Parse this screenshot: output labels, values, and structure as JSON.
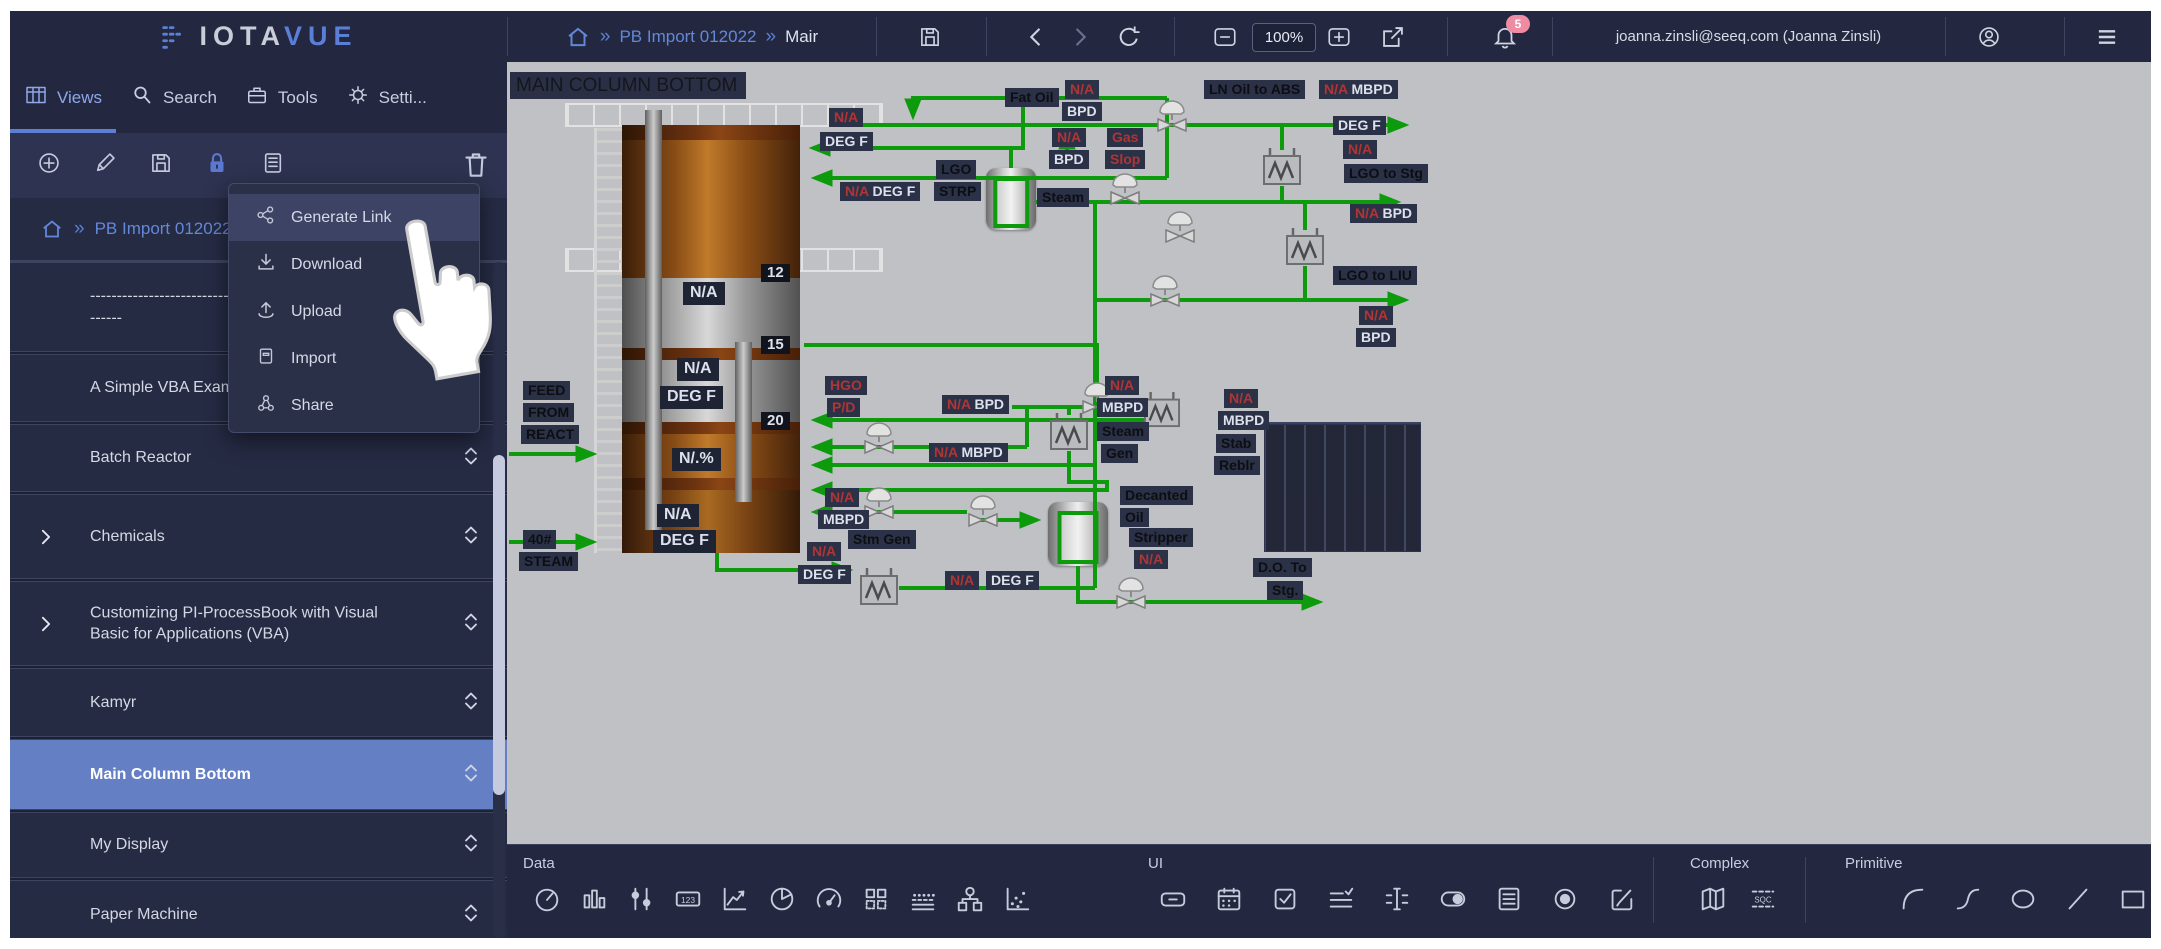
{
  "topbar": {
    "logo_part1": "IOTA",
    "logo_part2": "VUE",
    "breadcrumb": {
      "item1": "PB Import 012022",
      "item2": "Mair"
    },
    "zoom_level": "100%",
    "notifications_badge": "5",
    "user": "joanna.zinsli@seeq.com (Joanna Zinsli)"
  },
  "sidebar": {
    "tabs": [
      {
        "icon": "grid-icon",
        "label": "Views",
        "active": true
      },
      {
        "icon": "search-icon",
        "label": "Search",
        "active": false
      },
      {
        "icon": "tools-icon",
        "label": "Tools",
        "active": false
      },
      {
        "icon": "gear-icon",
        "label": "Setti...",
        "active": false
      }
    ],
    "toolbar_icons": [
      "add-icon",
      "edit-icon",
      "save-icon",
      "lock-icon",
      "list-icon"
    ],
    "breadcrumb": "PB Import 012022",
    "items": [
      {
        "name": "dashed-item",
        "label": "----------------------------------",
        "label2": "------",
        "h": 90,
        "sortable": false,
        "expandable": false,
        "selected": false
      },
      {
        "name": "a-simple-vba-exam",
        "label": "A Simple VBA Exam",
        "h": 68,
        "sortable": true,
        "expandable": false,
        "selected": false
      },
      {
        "name": "batch-reactor",
        "label": "Batch Reactor",
        "h": 68,
        "sortable": true,
        "expandable": false,
        "selected": false
      },
      {
        "name": "chemicals",
        "label": "Chemicals",
        "h": 85,
        "sortable": true,
        "expandable": true,
        "selected": false
      },
      {
        "name": "customizing-pi-processbook",
        "label": "Customizing PI-ProcessBook with Visual Basic for Applications (VBA)",
        "h": 85,
        "sortable": true,
        "expandable": true,
        "selected": false
      },
      {
        "name": "kamyr",
        "label": "Kamyr",
        "h": 69,
        "sortable": true,
        "expandable": false,
        "selected": false
      },
      {
        "name": "main-column-bottom",
        "label": "Main Column Bottom",
        "h": 71,
        "sortable": true,
        "expandable": false,
        "selected": true
      },
      {
        "name": "my-display",
        "label": "My Display",
        "h": 66,
        "sortable": true,
        "expandable": false,
        "selected": false
      },
      {
        "name": "paper-machine",
        "label": "Paper Machine",
        "h": 69,
        "sortable": true,
        "expandable": false,
        "selected": false
      }
    ]
  },
  "menu": {
    "items": [
      {
        "icon": "generate-link-icon",
        "label": "Generate Link",
        "highlighted": true
      },
      {
        "icon": "download-icon",
        "label": "Download",
        "highlighted": false
      },
      {
        "icon": "upload-icon",
        "label": "Upload",
        "highlighted": false
      },
      {
        "icon": "import-icon",
        "label": "Import",
        "highlighted": false
      },
      {
        "icon": "share-icon",
        "label": "Share",
        "highlighted": false
      }
    ]
  },
  "canvas": {
    "title": "MAIN COLUMN BOTTOM",
    "chips": [
      {
        "x": 322,
        "y": 46,
        "p": [
          [
            "N/A",
            "r"
          ]
        ]
      },
      {
        "x": 313,
        "y": 70,
        "p": [
          [
            "DEG F",
            "w"
          ]
        ]
      },
      {
        "x": 498,
        "y": 26,
        "p": [
          [
            "Fat Oil",
            "k"
          ]
        ]
      },
      {
        "x": 333,
        "y": 120,
        "p": [
          [
            "N/A",
            "r"
          ],
          [
            "DEG F",
            "w"
          ]
        ]
      },
      {
        "x": 429,
        "y": 98,
        "p": [
          [
            "LGO",
            "k"
          ]
        ]
      },
      {
        "x": 427,
        "y": 120,
        "p": [
          [
            "STRP",
            "k"
          ]
        ]
      },
      {
        "x": 530,
        "y": 126,
        "p": [
          [
            "Steam",
            "k"
          ]
        ]
      },
      {
        "x": 558,
        "y": 18,
        "p": [
          [
            "N/A",
            "r"
          ]
        ]
      },
      {
        "x": 555,
        "y": 40,
        "p": [
          [
            "BPD",
            "w"
          ]
        ]
      },
      {
        "x": 697,
        "y": 18,
        "p": [
          [
            "LN Oil to ABS",
            "k"
          ]
        ]
      },
      {
        "x": 812,
        "y": 18,
        "p": [
          [
            "N/A",
            "r"
          ],
          [
            "MBPD",
            "w"
          ]
        ]
      },
      {
        "x": 826,
        "y": 54,
        "p": [
          [
            "DEG F",
            "w"
          ]
        ]
      },
      {
        "x": 836,
        "y": 78,
        "p": [
          [
            "N/A",
            "r"
          ]
        ]
      },
      {
        "x": 545,
        "y": 66,
        "p": [
          [
            "N/A",
            "r"
          ]
        ]
      },
      {
        "x": 542,
        "y": 88,
        "p": [
          [
            "BPD",
            "w"
          ]
        ]
      },
      {
        "x": 600,
        "y": 66,
        "p": [
          [
            "Gas",
            "r"
          ]
        ]
      },
      {
        "x": 598,
        "y": 88,
        "p": [
          [
            "Slop",
            "r"
          ]
        ]
      },
      {
        "x": 837,
        "y": 102,
        "p": [
          [
            "LGO to Stg",
            "k"
          ]
        ]
      },
      {
        "x": 843,
        "y": 142,
        "p": [
          [
            "N/A",
            "r"
          ],
          [
            "BPD",
            "w"
          ]
        ]
      },
      {
        "x": 826,
        "y": 204,
        "p": [
          [
            "LGO to LIU",
            "k"
          ]
        ]
      },
      {
        "x": 852,
        "y": 244,
        "p": [
          [
            "N/A",
            "r"
          ]
        ]
      },
      {
        "x": 849,
        "y": 266,
        "p": [
          [
            "BPD",
            "w"
          ]
        ]
      },
      {
        "x": 318,
        "y": 314,
        "p": [
          [
            "HGO",
            "r"
          ]
        ]
      },
      {
        "x": 320,
        "y": 336,
        "p": [
          [
            "P/D",
            "r"
          ]
        ]
      },
      {
        "x": 435,
        "y": 333,
        "p": [
          [
            "N/A",
            "r"
          ],
          [
            "BPD",
            "w"
          ]
        ]
      },
      {
        "x": 598,
        "y": 314,
        "p": [
          [
            "N/A",
            "r"
          ]
        ]
      },
      {
        "x": 590,
        "y": 336,
        "p": [
          [
            "MBPD",
            "w"
          ]
        ]
      },
      {
        "x": 590,
        "y": 360,
        "p": [
          [
            "Steam",
            "k"
          ]
        ]
      },
      {
        "x": 594,
        "y": 382,
        "p": [
          [
            "Gen",
            "k"
          ]
        ]
      },
      {
        "x": 717,
        "y": 327,
        "p": [
          [
            "N/A",
            "r"
          ]
        ]
      },
      {
        "x": 711,
        "y": 349,
        "p": [
          [
            "MBPD",
            "w"
          ]
        ]
      },
      {
        "x": 709,
        "y": 372,
        "p": [
          [
            "Stab",
            "k"
          ]
        ]
      },
      {
        "x": 707,
        "y": 394,
        "p": [
          [
            "Reblr",
            "k"
          ]
        ]
      },
      {
        "x": 422,
        "y": 381,
        "p": [
          [
            "N/A",
            "r"
          ],
          [
            "MBPD",
            "w"
          ]
        ]
      },
      {
        "x": 318,
        "y": 426,
        "p": [
          [
            "N/A",
            "r"
          ]
        ]
      },
      {
        "x": 311,
        "y": 448,
        "p": [
          [
            "MBPD",
            "w"
          ]
        ]
      },
      {
        "x": 341,
        "y": 468,
        "p": [
          [
            "Stm Gen",
            "k"
          ]
        ]
      },
      {
        "x": 300,
        "y": 480,
        "p": [
          [
            "N/A",
            "r"
          ]
        ]
      },
      {
        "x": 291,
        "y": 503,
        "p": [
          [
            "DEG F",
            "w"
          ]
        ]
      },
      {
        "x": 438,
        "y": 509,
        "p": [
          [
            "N/A",
            "r"
          ]
        ]
      },
      {
        "x": 479,
        "y": 509,
        "p": [
          [
            "DEG F",
            "w"
          ]
        ]
      },
      {
        "x": 613,
        "y": 424,
        "p": [
          [
            "Decanted",
            "k"
          ]
        ]
      },
      {
        "x": 613,
        "y": 446,
        "p": [
          [
            "Oil",
            "k"
          ]
        ]
      },
      {
        "x": 622,
        "y": 466,
        "p": [
          [
            "Stripper",
            "k"
          ]
        ]
      },
      {
        "x": 627,
        "y": 488,
        "p": [
          [
            "N/A",
            "r"
          ]
        ]
      },
      {
        "x": 746,
        "y": 496,
        "p": [
          [
            "D.O. To",
            "k"
          ]
        ]
      },
      {
        "x": 760,
        "y": 519,
        "p": [
          [
            "Stg.",
            "k"
          ]
        ]
      },
      {
        "x": 16,
        "y": 319,
        "p": [
          [
            "FEED",
            "k"
          ]
        ]
      },
      {
        "x": 16,
        "y": 341,
        "p": [
          [
            "FROM",
            "k"
          ]
        ]
      },
      {
        "x": 14,
        "y": 363,
        "p": [
          [
            "REACT",
            "k"
          ]
        ]
      },
      {
        "x": 16,
        "y": 468,
        "p": [
          [
            "40#",
            "k"
          ]
        ]
      },
      {
        "x": 12,
        "y": 490,
        "p": [
          [
            "STEAM",
            "k"
          ]
        ]
      },
      {
        "x": 176,
        "y": 220,
        "cls": "box",
        "p": [
          [
            "N/A",
            "w"
          ]
        ]
      },
      {
        "x": 170,
        "y": 296,
        "cls": "box",
        "p": [
          [
            "N/A",
            "w"
          ]
        ]
      },
      {
        "x": 153,
        "y": 324,
        "cls": "box",
        "p": [
          [
            "DEG F",
            "w"
          ]
        ]
      },
      {
        "x": 165,
        "y": 386,
        "cls": "box",
        "p": [
          [
            "N/.%",
            "w"
          ]
        ]
      },
      {
        "x": 150,
        "y": 442,
        "cls": "box",
        "p": [
          [
            "N/A",
            "w"
          ]
        ]
      },
      {
        "x": 146,
        "y": 468,
        "cls": "box",
        "p": [
          [
            "DEG F",
            "w"
          ]
        ]
      },
      {
        "x": 254,
        "y": 202,
        "cls": "tray",
        "p": [
          [
            "12",
            "w"
          ]
        ]
      },
      {
        "x": 254,
        "y": 274,
        "cls": "tray",
        "p": [
          [
            "15",
            "w"
          ]
        ]
      },
      {
        "x": 254,
        "y": 350,
        "cls": "tray",
        "p": [
          [
            "20",
            "w"
          ]
        ]
      }
    ]
  },
  "bottom_toolbar": {
    "sections": [
      {
        "label": "Data",
        "left": 16,
        "icon_start": 22,
        "step": 47,
        "icons": [
          "gauge-icon",
          "bar-chart-icon",
          "slider-icon",
          "numeric-display-icon",
          "trend-icon",
          "pie-chart-icon",
          "dial-icon",
          "data-grid-icon",
          "area-icon",
          "tree-icon",
          "scatter-icon"
        ]
      },
      {
        "label": "UI",
        "left": 641,
        "icon_start": 648,
        "step": 56,
        "icons": [
          "button-icon",
          "date-picker-icon",
          "checkbox-icon",
          "multi-state-icon",
          "text-input-icon",
          "toggle-icon",
          "list-box-icon",
          "radio-icon",
          "edit-box-icon"
        ]
      },
      {
        "label": "Complex",
        "left": 1183,
        "icon_start": 1188,
        "step": 50,
        "icons": [
          "map-icon",
          "sqc-icon"
        ]
      },
      {
        "label": "Primitive",
        "left": 1338,
        "icon_start": 1388,
        "step": 55,
        "icons": [
          "arc-icon",
          "curve-icon",
          "ellipse-icon",
          "line-icon",
          "rectangle-icon"
        ]
      }
    ],
    "dividers": [
      1146,
      1298
    ]
  }
}
